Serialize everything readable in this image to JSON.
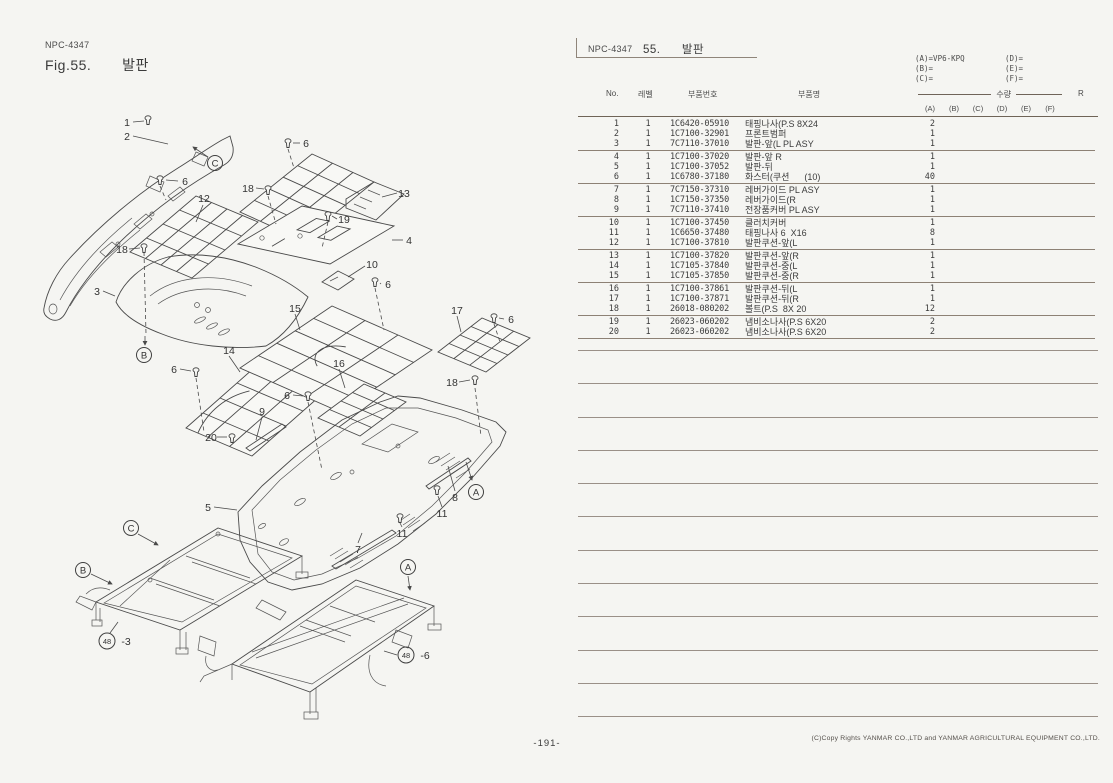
{
  "page": {
    "number": "-191-",
    "copyright": "(C)Copy Rights  YANMAR CO.,LTD and YANMAR AGRICULTURAL EQUIPMENT CO.,LTD."
  },
  "left_header": {
    "doc_code": "NPC-4347",
    "figure": "Fig.55.",
    "title": "발판"
  },
  "right_header": {
    "doc_code": "NPC-4347",
    "section_no": "55.",
    "title": "발판"
  },
  "legend": {
    "col1": [
      "(A)=VP6-KPQ",
      "(B)=",
      "(C)="
    ],
    "col2": [
      "(D)=",
      "(E)=",
      "(F)="
    ]
  },
  "table": {
    "headers": {
      "no": "No.",
      "level": "레벨",
      "part_no": "부품번호",
      "part_name": "부품명",
      "qty": "수량",
      "r": "R"
    },
    "qty_columns": [
      "(A)",
      "(B)",
      "(C)",
      "(D)",
      "(E)",
      "(F)"
    ],
    "rows": [
      {
        "no": "1",
        "level": "1",
        "part_no": "1C6420-05910",
        "part_name": "태핑나사(P.S 8X24",
        "qty_a": "2",
        "group_end": false
      },
      {
        "no": "2",
        "level": "1",
        "part_no": "1C7100-32901",
        "part_name": "프론트범퍼",
        "qty_a": "1",
        "group_end": false
      },
      {
        "no": "3",
        "level": "1",
        "part_no": "7C7110-37010",
        "part_name": "발판-앞(L PL ASY",
        "qty_a": "1",
        "group_end": true
      },
      {
        "no": "4",
        "level": "1",
        "part_no": "1C7100-37020",
        "part_name": "발판-앞 R",
        "qty_a": "1",
        "group_end": false
      },
      {
        "no": "5",
        "level": "1",
        "part_no": "1C7100-37052",
        "part_name": "발판-뒤",
        "qty_a": "1",
        "group_end": false
      },
      {
        "no": "6",
        "level": "1",
        "part_no": "1C6780-37180",
        "part_name": "화스터(쿠션      (10)",
        "qty_a": "40",
        "group_end": true
      },
      {
        "no": "7",
        "level": "1",
        "part_no": "7C7150-37310",
        "part_name": "레버가이드 PL ASY",
        "qty_a": "1",
        "group_end": false
      },
      {
        "no": "8",
        "level": "1",
        "part_no": "1C7150-37350",
        "part_name": "레버가이드(R",
        "qty_a": "1",
        "group_end": false
      },
      {
        "no": "9",
        "level": "1",
        "part_no": "7C7110-37410",
        "part_name": "전장품커버 PL ASY",
        "qty_a": "1",
        "group_end": true
      },
      {
        "no": "10",
        "level": "1",
        "part_no": "1C7100-37450",
        "part_name": "클러치커버",
        "qty_a": "1",
        "group_end": false
      },
      {
        "no": "11",
        "level": "1",
        "part_no": "1C6650-37480",
        "part_name": "태핑나사 6  X16",
        "qty_a": "8",
        "group_end": false
      },
      {
        "no": "12",
        "level": "1",
        "part_no": "1C7100-37810",
        "part_name": "발판쿠션-앞(L",
        "qty_a": "1",
        "group_end": true
      },
      {
        "no": "13",
        "level": "1",
        "part_no": "1C7100-37820",
        "part_name": "발판쿠션-앞(R",
        "qty_a": "1",
        "group_end": false
      },
      {
        "no": "14",
        "level": "1",
        "part_no": "1C7105-37840",
        "part_name": "발판쿠션-중(L",
        "qty_a": "1",
        "group_end": false
      },
      {
        "no": "15",
        "level": "1",
        "part_no": "1C7105-37850",
        "part_name": "발판쿠션-중(R",
        "qty_a": "1",
        "group_end": true
      },
      {
        "no": "16",
        "level": "1",
        "part_no": "1C7100-37861",
        "part_name": "발판쿠션-뒤(L",
        "qty_a": "1",
        "group_end": false
      },
      {
        "no": "17",
        "level": "1",
        "part_no": "1C7100-37871",
        "part_name": "발판쿠션-뒤(R",
        "qty_a": "1",
        "group_end": false
      },
      {
        "no": "18",
        "level": "1",
        "part_no": "26018-080202",
        "part_name": "볼트(P.S  8X 20",
        "qty_a": "12",
        "group_end": true
      },
      {
        "no": "19",
        "level": "1",
        "part_no": "26023-060202",
        "part_name": "냄비소나사(P.S 6X20",
        "qty_a": "2",
        "group_end": false
      },
      {
        "no": "20",
        "level": "1",
        "part_no": "26023-060202",
        "part_name": "냄비소나사(P.S 6X20",
        "qty_a": "2",
        "group_end": true
      }
    ]
  },
  "diagram": {
    "callouts": {
      "n1": "1",
      "n2": "2",
      "n3": "3",
      "n4": "4",
      "n5": "5",
      "n6": "6",
      "n7": "7",
      "n8": "8",
      "n9": "9",
      "n10": "10",
      "n11": "11",
      "n12": "12",
      "n13": "13",
      "n14": "14",
      "n15": "15",
      "n16": "16",
      "n17": "17",
      "n18": "18",
      "n19": "19",
      "n20": "20",
      "refA": "A",
      "refB": "B",
      "refC": "C",
      "ref48": "48",
      "suffix3": "-3",
      "suffix6": "-6"
    }
  }
}
